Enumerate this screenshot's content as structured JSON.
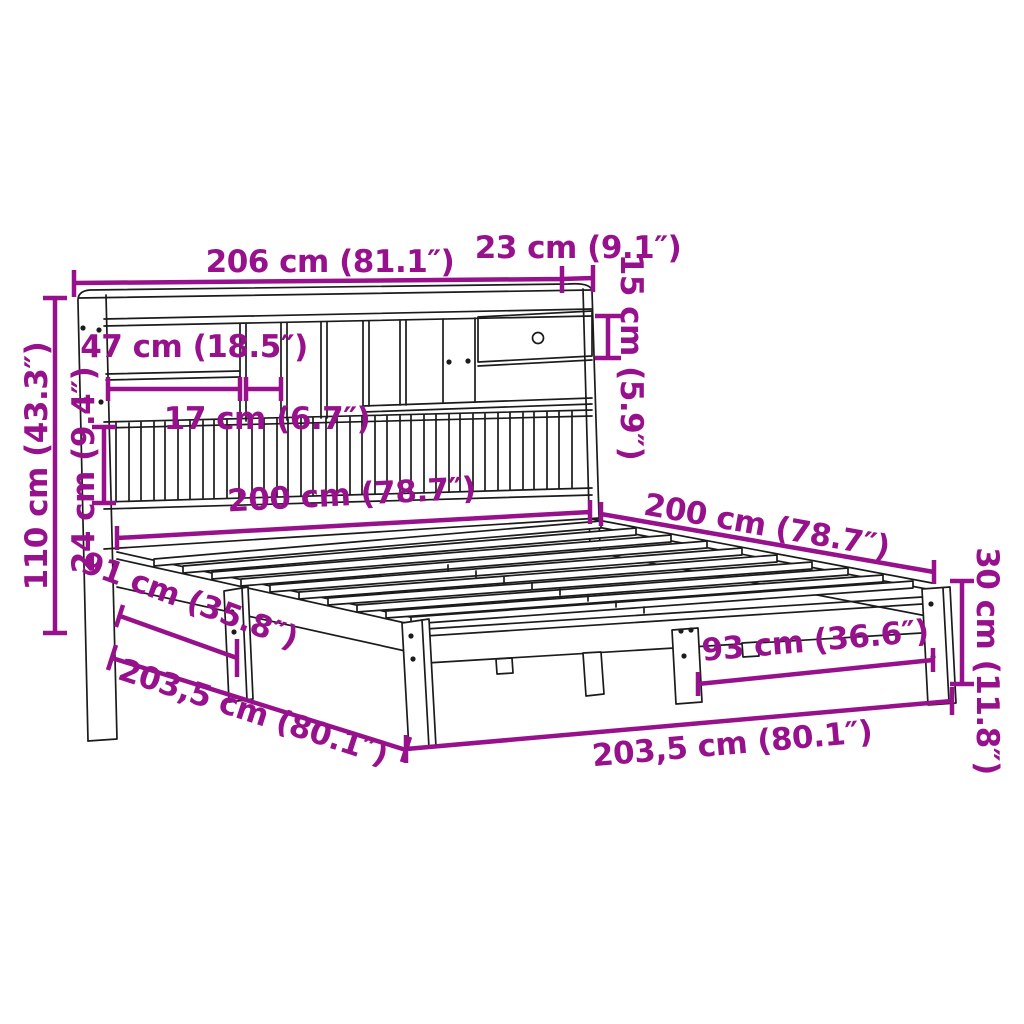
{
  "diagram": {
    "colors": {
      "accent": "#97118C",
      "line": "#1B1B1B",
      "background": "#FFFFFF"
    },
    "dimensions": {
      "headboard_width": "206 cm (81.1″)",
      "headboard_depth": "23 cm (9.1″)",
      "drawer_height": "15 cm (5.9″)",
      "shelf_width": "47 cm (18.5″)",
      "compartment_width": "17 cm (6.7″)",
      "headboard_height": "110 cm (43.3″)",
      "slat_panel_height": "24 cm (9.4″)",
      "bed_width": "200 cm (78.7″)",
      "bed_length": "200 cm (78.7″)",
      "frame_height": "30 cm (11.8″)",
      "foot_leg_spacing": "93 cm (36.6″)",
      "side_leg_spacing": "91 cm (35.8″)",
      "frame_length_left": "203,5 cm (80.1″)",
      "frame_length_right": "203,5 cm (80.1″)"
    }
  }
}
